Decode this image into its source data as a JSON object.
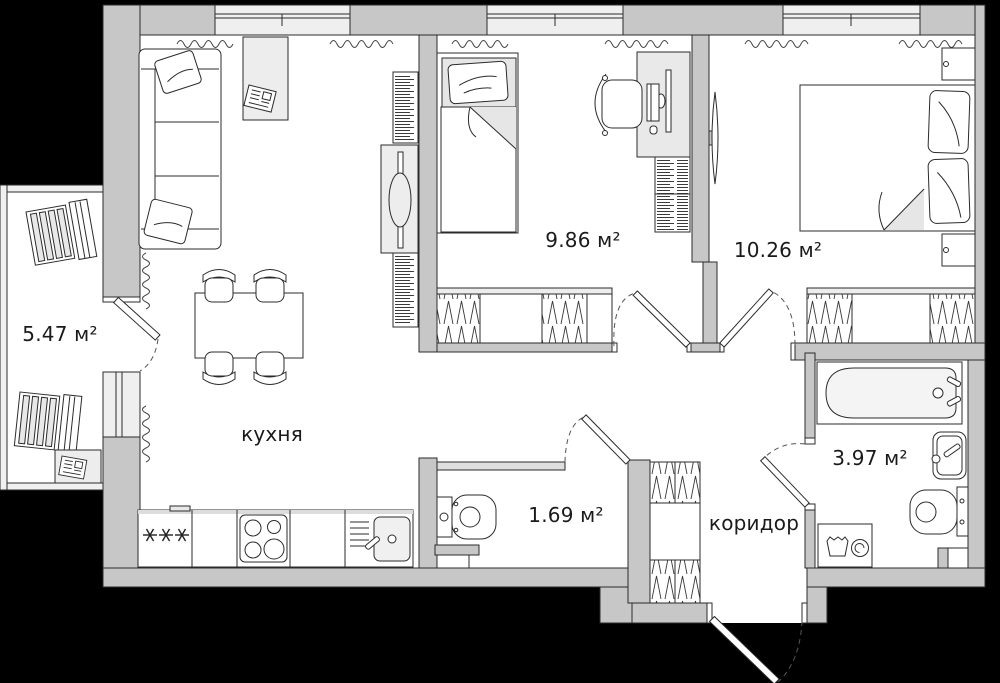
{
  "plan": {
    "type": "apartment-floor-plan",
    "rooms": {
      "balcony": {
        "area_label": "5.47 м²"
      },
      "kitchen": {
        "name_label": "кухня"
      },
      "bedroom_small": {
        "area_label": "9.86 м²"
      },
      "bedroom_large": {
        "area_label": "10.26 м²"
      },
      "wc": {
        "area_label": "1.69 м²"
      },
      "corridor": {
        "name_label": "коридор"
      },
      "bathroom": {
        "area_label": "3.97 м²"
      }
    },
    "colors": {
      "background": "#000000",
      "floor": "#ffffff",
      "wall": "#c7c7c7",
      "thin_partition": "#dedede",
      "window_glass": "#efefef",
      "furniture_panel": "#ececec",
      "mattress": "#e6e6e6",
      "outline": "#2b2b2b",
      "label_text": "#1a1a1a"
    },
    "furniture_icons": [
      "sofa-icon",
      "coffee-table-icon",
      "newspaper-icon",
      "tv-icon",
      "bookshelf-icon",
      "dining-table-icon",
      "dining-chair-icon",
      "kitchen-counter-icon",
      "fridge-icon",
      "stove-icon",
      "kitchen-sink-icon",
      "lounge-chair-icon",
      "balcony-table-icon",
      "single-bed-icon",
      "pillow-icon",
      "desk-icon",
      "desk-chair-icon",
      "computer-icon",
      "shelf-icon",
      "wardrobe-icon",
      "double-bed-icon",
      "nightstand-icon",
      "toilet-icon",
      "bathtub-icon",
      "bathroom-sink-icon",
      "washing-machine-icon",
      "radiator-icon",
      "door-icon",
      "window-icon"
    ]
  }
}
